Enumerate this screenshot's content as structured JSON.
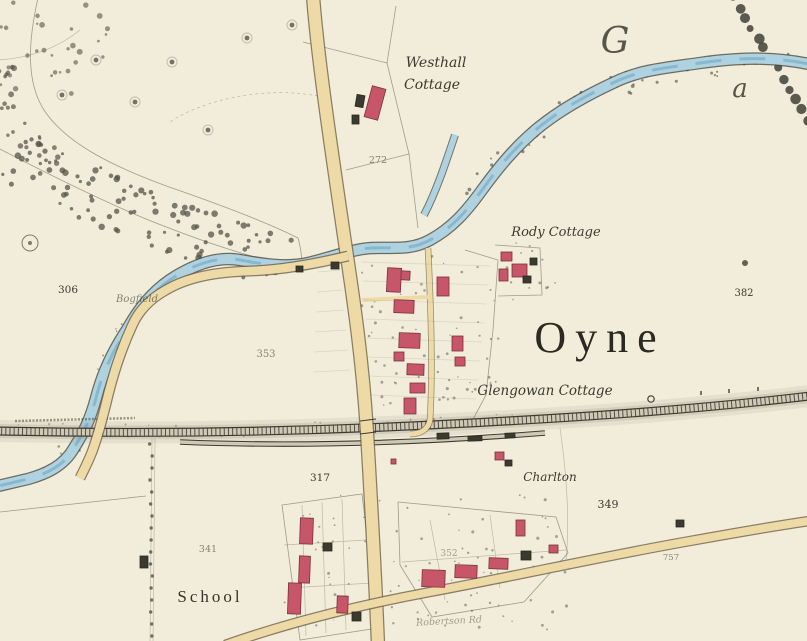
{
  "map": {
    "town_name": "Oyne",
    "labels": {
      "westhall_line1": {
        "text": "Westhall"
      },
      "westhall_line2": {
        "text": "Cottage"
      },
      "rody": {
        "text": "Rody Cottage"
      },
      "oyne": {
        "text": "Oyne"
      },
      "glengowan": {
        "text": "Glengowan Cottage"
      },
      "bogfield": {
        "text": "Bogfield"
      },
      "charlton": {
        "text": "Charlton"
      },
      "school": {
        "text": "School"
      },
      "road_name": {
        "text": "Robertson Rd"
      },
      "river_letter_g": {
        "text": "G"
      },
      "river_letter_a": {
        "text": "a"
      }
    },
    "parcel_numbers": {
      "n272": {
        "text": "272"
      },
      "n306": {
        "text": "306"
      },
      "n353": {
        "text": "353"
      },
      "n317": {
        "text": "317"
      },
      "n341": {
        "text": "341"
      },
      "n349": {
        "text": "349"
      },
      "n352": {
        "text": "352"
      },
      "n382": {
        "text": "382"
      },
      "n757": {
        "text": "757"
      }
    },
    "colors": {
      "paper": "#f2edda",
      "water": "#aed2e0",
      "water_line": "#7fb2c8",
      "road": "#eedaa6",
      "road_edge": "#6f6046",
      "building_red": "#c8566a",
      "building_edge": "#7a303f",
      "ink": "#3a3a30",
      "tree": "#53534a",
      "rail_bed": "#cfc8b4"
    },
    "buildings": [
      [
        368,
        87,
        14,
        32,
        15,
        "red"
      ],
      [
        356,
        95,
        8,
        12,
        10,
        "dark"
      ],
      [
        352,
        115,
        7,
        9,
        0,
        "dark"
      ],
      [
        387,
        268,
        14,
        24,
        3,
        "red"
      ],
      [
        401,
        271,
        9,
        9,
        3,
        "red"
      ],
      [
        394,
        300,
        20,
        13,
        2,
        "red"
      ],
      [
        399,
        333,
        21,
        15,
        2,
        "red"
      ],
      [
        394,
        352,
        10,
        9,
        0,
        "red"
      ],
      [
        407,
        364,
        17,
        11,
        2,
        "red"
      ],
      [
        410,
        383,
        15,
        10,
        0,
        "red"
      ],
      [
        404,
        398,
        12,
        16,
        0,
        "red"
      ],
      [
        437,
        277,
        12,
        19,
        0,
        "red"
      ],
      [
        452,
        336,
        11,
        15,
        0,
        "red"
      ],
      [
        455,
        357,
        10,
        9,
        0,
        "red"
      ],
      [
        501,
        252,
        11,
        9,
        0,
        "red"
      ],
      [
        512,
        264,
        15,
        13,
        0,
        "red"
      ],
      [
        499,
        269,
        9,
        12,
        0,
        "red"
      ],
      [
        523,
        276,
        8,
        7,
        0,
        "dark"
      ],
      [
        530,
        258,
        7,
        7,
        0,
        "dark"
      ],
      [
        331,
        262,
        8,
        7,
        0,
        "dark"
      ],
      [
        296,
        266,
        7,
        6,
        0,
        "dark"
      ],
      [
        495,
        452,
        9,
        8,
        0,
        "red"
      ],
      [
        505,
        460,
        7,
        6,
        0,
        "dark"
      ],
      [
        391,
        459,
        5,
        5,
        0,
        "red"
      ],
      [
        437,
        433,
        12,
        6,
        -2,
        "dark"
      ],
      [
        468,
        436,
        14,
        5,
        -2,
        "dark"
      ],
      [
        505,
        433,
        10,
        5,
        -3,
        "dark"
      ],
      [
        300,
        518,
        13,
        26,
        2,
        "red"
      ],
      [
        299,
        556,
        11,
        27,
        2,
        "red"
      ],
      [
        288,
        583,
        13,
        31,
        2,
        "red"
      ],
      [
        323,
        543,
        9,
        8,
        0,
        "dark"
      ],
      [
        337,
        596,
        11,
        17,
        2,
        "red"
      ],
      [
        352,
        612,
        9,
        9,
        0,
        "dark"
      ],
      [
        422,
        570,
        23,
        17,
        2,
        "red"
      ],
      [
        455,
        565,
        22,
        13,
        2,
        "red"
      ],
      [
        489,
        558,
        19,
        11,
        2,
        "red"
      ],
      [
        516,
        520,
        9,
        16,
        0,
        "red"
      ],
      [
        521,
        551,
        10,
        9,
        0,
        "dark"
      ],
      [
        549,
        545,
        9,
        8,
        0,
        "red"
      ],
      [
        676,
        520,
        8,
        7,
        0,
        "dark"
      ],
      [
        140,
        556,
        8,
        12,
        0,
        "dark"
      ]
    ]
  }
}
